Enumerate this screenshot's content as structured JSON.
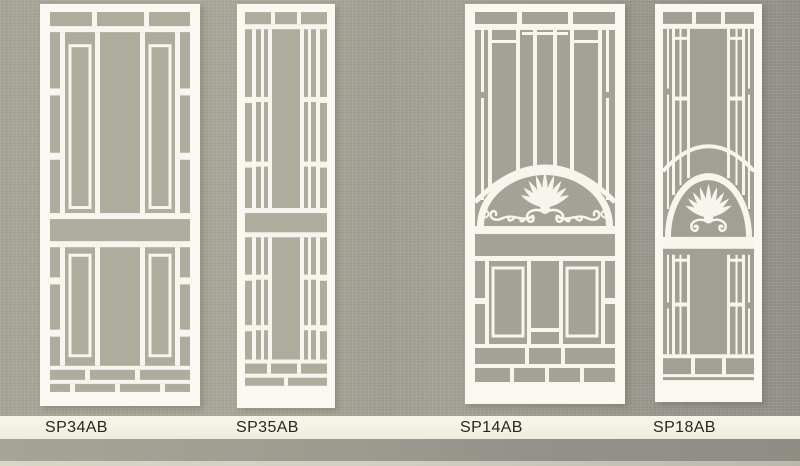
{
  "page": {
    "title": "Security door grille designs catalog page",
    "type": "scanned product catalog"
  },
  "colors": {
    "background_left": "#a9a89a",
    "background_right": "#94938a",
    "door_panel_fill": "#aeac9d",
    "door_panel_fill_dark": "#a4a196",
    "grille_white": "#f7f6ee",
    "label_band": "#f4f2e3",
    "label_text": "#262626",
    "bottom_edge_stripe": "#d8d7c6"
  },
  "products": [
    {
      "code": "SP34AB"
    },
    {
      "code": "SP35AB"
    },
    {
      "code": "SP14AB"
    },
    {
      "code": "SP18AB"
    }
  ],
  "motifs": {
    "shell": "palmette-shell-motif",
    "scroll": "scroll-flourish-motif"
  }
}
